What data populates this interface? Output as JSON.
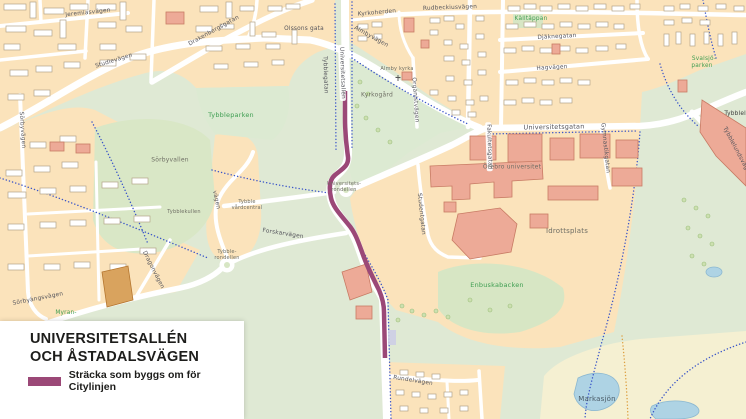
{
  "title_card": {
    "line1": "UNIVERSITETSALLÉN",
    "line2": "OCH ÅSTADALSVÄGEN",
    "legend_label": "Sträcka som byggs om för Citylinjen"
  },
  "colors": {
    "route": "#9b4877",
    "residential": "#fbe3bb",
    "park_green": "#dce9d2",
    "field_green": "#d7e6c4",
    "open_field_yellow": "#f5f0d2",
    "water": "#aed3e4",
    "building_salmon": "#edaa97",
    "building_tan": "#d9a35e",
    "road_white": "#ffffff",
    "cycle_path_blue": "#3a55c8",
    "trail_orange": "#dd9f3f"
  },
  "map": {
    "labels": [
      {
        "text": "Jeremiasvägen",
        "x": 88,
        "y": 13,
        "rot": -6,
        "cls": "street tiny"
      },
      {
        "text": "Drakenbergsgatan",
        "x": 214,
        "y": 31,
        "rot": -29,
        "cls": "street tiny"
      },
      {
        "text": "Studievägen",
        "x": 114,
        "y": 61,
        "rot": -17,
        "cls": "street tiny"
      },
      {
        "text": "Sörbyvägen",
        "x": 22,
        "y": 130,
        "rot": 86,
        "cls": "street tiny"
      },
      {
        "text": "Olssons gata",
        "x": 304,
        "y": 29,
        "rot": 0,
        "cls": "street tiny"
      },
      {
        "text": "Kyrkoherden",
        "x": 377,
        "y": 13,
        "rot": -5,
        "cls": "street tiny"
      },
      {
        "text": "Rudbeckiusvägen",
        "x": 450,
        "y": 8,
        "rot": -2,
        "cls": "street tiny"
      },
      {
        "text": "Almbyvägen",
        "x": 371,
        "y": 37,
        "rot": 29,
        "cls": "street tiny"
      },
      {
        "text": "Organistvägen",
        "x": 415,
        "y": 100,
        "rot": 86,
        "cls": "street tiny"
      },
      {
        "text": "Djäknegatan",
        "x": 557,
        "y": 37,
        "rot": -3,
        "cls": "street tiny"
      },
      {
        "text": "Hagvägen",
        "x": 552,
        "y": 68,
        "rot": -3,
        "cls": "street tiny"
      },
      {
        "text": "Universitetsgatan",
        "x": 554,
        "y": 127,
        "rot": -1,
        "cls": "street"
      },
      {
        "text": "Gymnastikgatan",
        "x": 605,
        "y": 148,
        "rot": 84,
        "cls": "street tiny"
      },
      {
        "text": "Fakultetsgatan",
        "x": 489,
        "y": 147,
        "rot": 88,
        "cls": "street tiny pill"
      },
      {
        "text": "Universitetsallén",
        "x": 342,
        "y": 73,
        "rot": 88,
        "cls": "street tiny pill"
      },
      {
        "text": "Tybblegatan",
        "x": 325,
        "y": 75,
        "rot": 88,
        "cls": "street tiny"
      },
      {
        "text": "Studentgatan",
        "x": 421,
        "y": 214,
        "rot": 84,
        "cls": "street tiny"
      },
      {
        "text": "Forskarvägen",
        "x": 283,
        "y": 234,
        "rot": 9,
        "cls": "street tiny"
      },
      {
        "text": "Dragonvägen",
        "x": 153,
        "y": 270,
        "rot": 63,
        "cls": "street tiny"
      },
      {
        "text": "Sörbyängsvägen",
        "x": 38,
        "y": 299,
        "rot": -11,
        "cls": "street tiny"
      },
      {
        "text": "Rundelvägen",
        "x": 413,
        "y": 381,
        "rot": 9,
        "cls": "street tiny"
      },
      {
        "text": "Tybblelundsvägen",
        "x": 737,
        "y": 152,
        "rot": 62,
        "cls": "street tiny"
      },
      {
        "text": "vägen",
        "x": 216,
        "y": 200,
        "rot": 78,
        "cls": "street tiny"
      },
      {
        "text": "Tybbleparken",
        "x": 231,
        "y": 115,
        "rot": 0,
        "cls": "park"
      },
      {
        "text": "Källtäppan",
        "x": 531,
        "y": 19,
        "rot": 0,
        "cls": "park tiny"
      },
      {
        "text": "Svalsjö-",
        "x": 704,
        "y": 59,
        "rot": 0,
        "cls": "park tiny"
      },
      {
        "text": "parken",
        "x": 702,
        "y": 66,
        "rot": 0,
        "cls": "park tiny"
      },
      {
        "text": "Enbuskabacken",
        "x": 497,
        "y": 285,
        "rot": 0,
        "cls": "park"
      },
      {
        "text": "Myran-",
        "x": 66,
        "y": 313,
        "rot": 0,
        "cls": "park tiny"
      },
      {
        "text": "Sörbyvallen",
        "x": 170,
        "y": 160,
        "rot": 0,
        "cls": "area tiny"
      },
      {
        "text": "Kyrkogård",
        "x": 377,
        "y": 95,
        "rot": 0,
        "cls": "area tiny"
      },
      {
        "text": "Idrottsplats",
        "x": 567,
        "y": 231,
        "rot": 0,
        "cls": "area"
      },
      {
        "text": "Örebro universitet",
        "x": 512,
        "y": 167,
        "rot": 0,
        "cls": "area tiny"
      },
      {
        "text": "Tybblekullen",
        "x": 184,
        "y": 212,
        "rot": 0,
        "cls": "area micro"
      },
      {
        "text": "Markasjön",
        "x": 597,
        "y": 399,
        "rot": 0,
        "cls": "water"
      },
      {
        "text": "Universitets-",
        "x": 344,
        "y": 184,
        "rot": 0,
        "cls": "area micro"
      },
      {
        "text": "rondellen",
        "x": 344,
        "y": 190,
        "rot": 0,
        "cls": "area micro"
      },
      {
        "text": "Tybble-",
        "x": 227,
        "y": 252,
        "rot": 0,
        "cls": "area micro"
      },
      {
        "text": "rondellen",
        "x": 227,
        "y": 258,
        "rot": 0,
        "cls": "area micro"
      },
      {
        "text": "Tybble",
        "x": 247,
        "y": 202,
        "rot": 0,
        "cls": "area micro"
      },
      {
        "text": "vårdcentral",
        "x": 247,
        "y": 208,
        "rot": 0,
        "cls": "area micro"
      },
      {
        "text": "Almby kyrka",
        "x": 397,
        "y": 69,
        "rot": 0,
        "cls": "area micro"
      },
      {
        "text": "Tybblelun",
        "x": 739,
        "y": 114,
        "rot": 0,
        "cls": "bld tiny"
      }
    ]
  }
}
